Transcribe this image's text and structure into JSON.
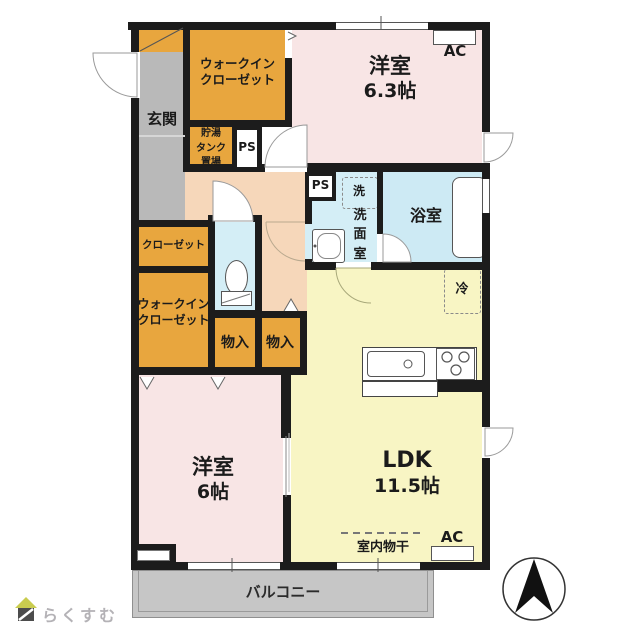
{
  "plan_title": "2LDK floor plan",
  "rooms": {
    "genkan": {
      "label": "玄関"
    },
    "wic_top": {
      "label": "ウォークイン\nクローゼット"
    },
    "tank": {
      "label": "貯湯\nタンク\n置場"
    },
    "ps_top": {
      "label": "PS"
    },
    "ps_mid": {
      "label": "PS"
    },
    "bedroom_63": {
      "name": "洋室",
      "area": "6.3帖"
    },
    "washroom": {
      "washer": "洗",
      "label_vertical": "洗\n面\n室"
    },
    "bathroom": {
      "label": "浴室"
    },
    "closet": {
      "label": "クローゼット"
    },
    "wic_left": {
      "label": "ウォークイン\nクローゼット"
    },
    "storage_1": {
      "label": "物入"
    },
    "storage_2": {
      "label": "物入"
    },
    "bedroom_6": {
      "name": "洋室",
      "area": "6帖"
    },
    "ldk": {
      "name": "LDK",
      "area": "11.5帖"
    },
    "fridge": {
      "label": "冷"
    },
    "indoor_drying": {
      "label": "室内物干"
    },
    "balcony": {
      "label": "バルコニー"
    },
    "ac_top": {
      "label": "AC"
    },
    "ac_bottom": {
      "label": "AC"
    }
  },
  "branding": {
    "logo_text": "らくすむ"
  },
  "colors": {
    "wall": "#1c1c1c",
    "bedroom_pink": "#f8e5e5",
    "ldk_yellow": "#f8f5c4",
    "closet_orange": "#e8a63e",
    "hall_peach": "#f6d7ba",
    "wet_cyan": "#d4eef6",
    "entry_gray": "#b9b9b9",
    "balcony_gray": "#c6c6c6"
  }
}
